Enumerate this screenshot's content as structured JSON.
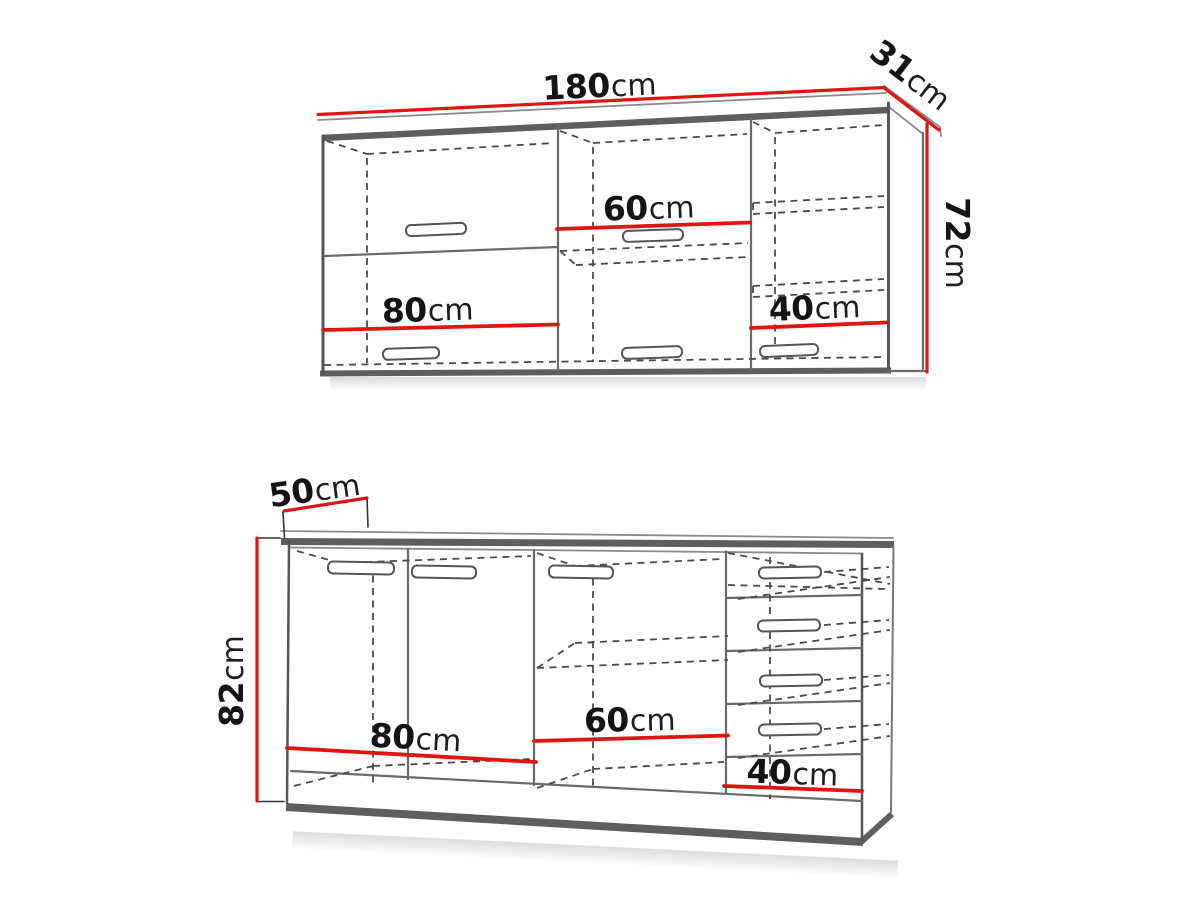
{
  "upper_cabinet": {
    "name": "upper-wall-cabinet",
    "labels": {
      "width": {
        "value": "180",
        "unit": "cm"
      },
      "depth": {
        "value": "31",
        "unit": "cm"
      },
      "height": {
        "value": "72",
        "unit": "cm"
      },
      "section_left_width": {
        "value": "80",
        "unit": "cm"
      },
      "section_middle_width": {
        "value": "60",
        "unit": "cm"
      },
      "section_right_width": {
        "value": "40",
        "unit": "cm"
      }
    }
  },
  "lower_cabinet": {
    "name": "lower-base-cabinet",
    "labels": {
      "depth": {
        "value": "50",
        "unit": "cm"
      },
      "height": {
        "value": "82",
        "unit": "cm"
      },
      "section_left_width": {
        "value": "80",
        "unit": "cm"
      },
      "section_middle_width": {
        "value": "60",
        "unit": "cm"
      },
      "section_right_width": {
        "value": "40",
        "unit": "cm"
      }
    }
  },
  "colors": {
    "dimension_line_red": "#e01410",
    "cabinet_outline_gray": "#5e5e5e",
    "label_text": "#141414",
    "background": "#ffffff"
  }
}
